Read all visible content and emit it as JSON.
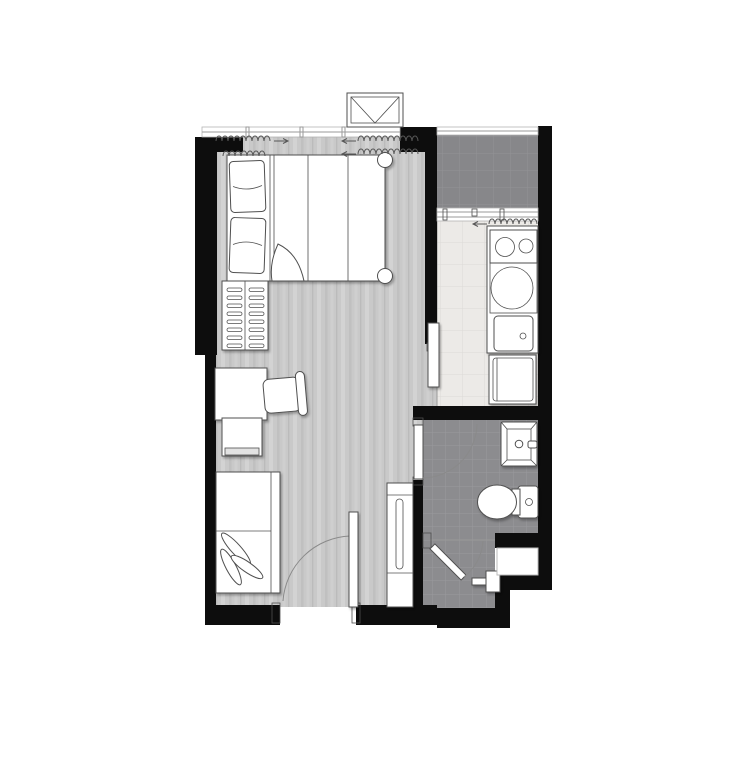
{
  "document": {
    "type": "architectural-floor-plan",
    "description": "Studio apartment unit floor plan, top-down view, no text labels rendered",
    "canvas": {
      "width": 746,
      "height": 768
    }
  },
  "colors": {
    "bg": "#ffffff",
    "wall": "#0d0d0d",
    "wood_base": "#c9c9c9",
    "wood_streak_light": "#d6d6d6",
    "wood_streak_dark": "#bbbbbb",
    "balcony_tile": "#87878a",
    "balcony_tile_line": "#939396",
    "bath_tile": "#8c8c8f",
    "bath_tile_line": "#9a9a9d",
    "kitchen_tile": "#eceae7",
    "kitchen_tile_line": "#dcdad7",
    "fixture_stroke": "#4f4f4f",
    "door_arc": "#8a8a8a",
    "window_line": "#9a9a9a"
  },
  "rooms": [
    {
      "id": "bedroom-living",
      "floor": "wood-plank"
    },
    {
      "id": "kitchen",
      "floor": "light-tile"
    },
    {
      "id": "balcony-ac-ledge",
      "floor": "dark-tile"
    },
    {
      "id": "bathroom",
      "floor": "dark-tile"
    },
    {
      "id": "shower",
      "floor": "dark-tile"
    },
    {
      "id": "service-niche",
      "floor": "white"
    }
  ],
  "fixtures": [
    "air-conditioner-outdoor-unit",
    "window-band",
    "curtains",
    "double-bed",
    "pillow",
    "pillow",
    "duvet-fold",
    "bed-post",
    "bed-post",
    "hanger-rack",
    "desk",
    "chair",
    "side-table",
    "sofa",
    "leaf-cushions",
    "entrance-door",
    "entry-partition",
    "sliding-panel-kitchen",
    "kitchen-counter",
    "stove-two-burner",
    "washing-machine",
    "kitchen-sink",
    "refrigerator",
    "balcony-sliding-door",
    "bathroom-door",
    "bathroom-sink",
    "faucet",
    "toilet",
    "shower-door",
    "shower-mixer",
    "wardrobe-with-mirror"
  ],
  "curtains": [
    {
      "x": 216,
      "y": 141,
      "length": 58,
      "arrow": "right"
    },
    {
      "x": 223,
      "y": 156,
      "length": 44,
      "arrow": "none"
    },
    {
      "x": 358,
      "y": 141,
      "length": 64,
      "arrow": "left"
    },
    {
      "x": 358,
      "y": 154,
      "length": 64,
      "arrow": "left"
    },
    {
      "x": 489,
      "y": 224,
      "length": 50,
      "arrow": "left"
    }
  ],
  "curtain_style": {
    "bump_width": 6,
    "bump_height": 5
  },
  "hanger_rack": {
    "x": 222,
    "y": 281,
    "width": 46,
    "height": 69,
    "rows": 8,
    "row_start_y": 288,
    "row_step": 8,
    "pill_left_x": 227,
    "pill_right_x": 249,
    "pill_width": 15,
    "pill_height": 3.5
  }
}
